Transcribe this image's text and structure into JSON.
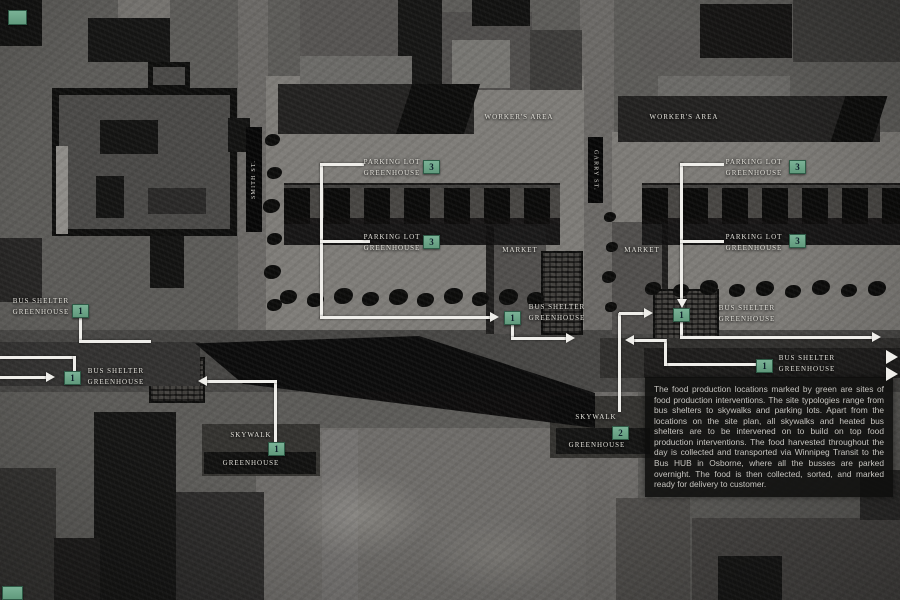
{
  "ui": {
    "colors": {
      "badge_green": "#6fa98c",
      "annotation_white": "#efeeea"
    },
    "streets": {
      "smith": "SMITH ST.",
      "garry": "GARRY ST."
    },
    "areas": {
      "workers_area_center": "WORKER'S AREA",
      "workers_area_east": "WORKER'S AREA",
      "market_center": "MARKET",
      "market_east": "MARKET"
    },
    "callouts": [
      {
        "id": "bus-shelter-northwest",
        "line1": "BUS SHELTER",
        "line2": "GREENHOUSE",
        "badge": "1"
      },
      {
        "id": "bus-shelter-west",
        "line1": "BUS SHELTER",
        "line2": "GREENHOUSE",
        "badge": "1"
      },
      {
        "id": "parking-lot-center-north",
        "line1": "PARKING LOT",
        "line2": "GREENHOUSE",
        "badge": "3"
      },
      {
        "id": "parking-lot-center-south",
        "line1": "PARKING LOT",
        "line2": "GREENHOUSE",
        "badge": "3"
      },
      {
        "id": "bus-shelter-center",
        "line1": "BUS SHELTER",
        "line2": "GREENHOUSE",
        "badge": "1"
      },
      {
        "id": "parking-lot-east-north",
        "line1": "PARKING LOT",
        "line2": "GREENHOUSE",
        "badge": "3"
      },
      {
        "id": "parking-lot-east-south",
        "line1": "PARKING LOT",
        "line2": "GREENHOUSE",
        "badge": "3"
      },
      {
        "id": "bus-shelter-garry",
        "line1": "BUS SHELTER",
        "line2": "GREENHOUSE",
        "badge": "1"
      },
      {
        "id": "bus-shelter-southeast",
        "line1": "BUS SHELTER",
        "line2": "GREENHOUSE",
        "badge": "1"
      },
      {
        "id": "skywalk-west",
        "line1": "SKYWALK",
        "line2": "GREENHOUSE",
        "badge": "1"
      },
      {
        "id": "skywalk-east",
        "line1": "SKYWALK",
        "line2": "GREENHOUSE",
        "badge": "2"
      }
    ],
    "corner_badges": [
      {
        "label": ""
      },
      {
        "label": ""
      }
    ],
    "legend_note": "The food production locations marked by green are sites of food production interventions. The site typologies range from bus shelters to skywalks and parking lots. Apart from the locations on the site plan, all skywalks and heated bus shelters are to be intervened on to build on top food production interventions. The food harvested throughout the day is collected and transported via Winnipeg Transit to the Bus HUB in Osborne, where all the busses are parked overnight. The food is then collected, sorted, and marked ready for delivery to customer."
  }
}
